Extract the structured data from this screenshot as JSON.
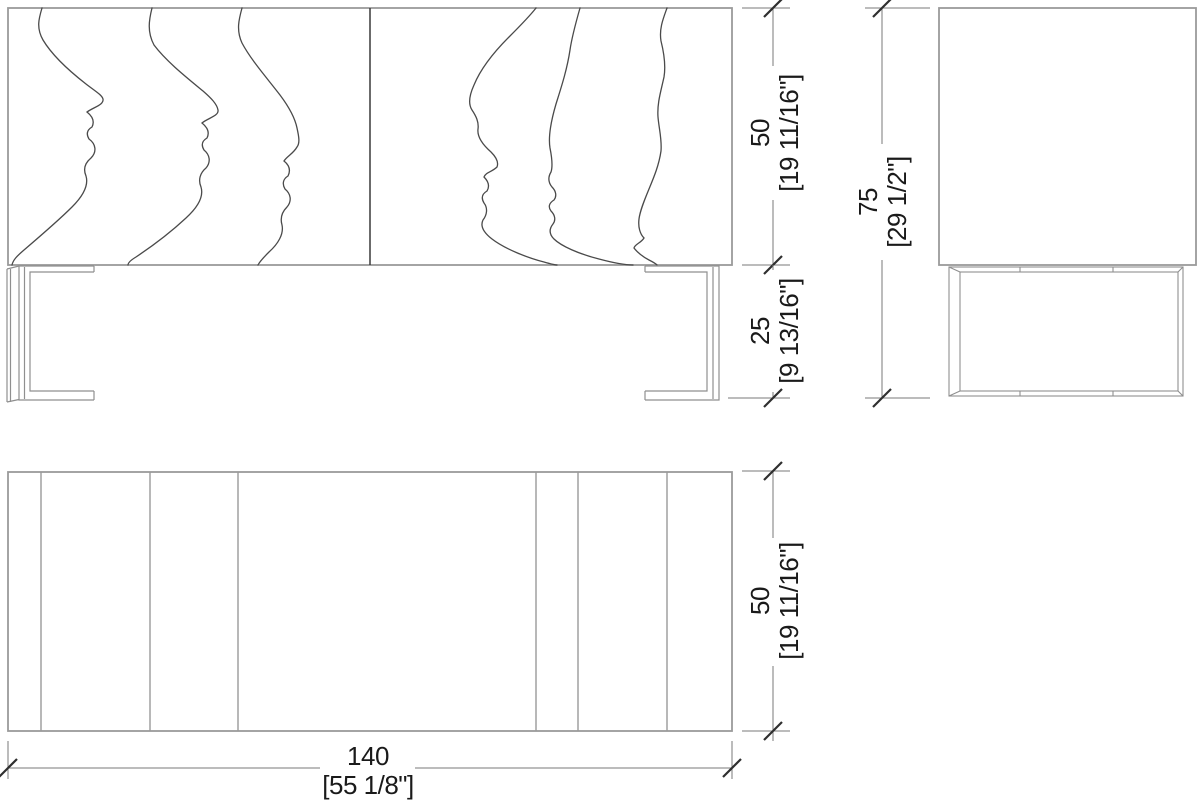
{
  "drawing_type": "furniture-dimension-drawing",
  "dimensions": {
    "cabinet_height": {
      "metric": "50",
      "imperial": "[19 11/16\"]"
    },
    "leg_height": {
      "metric": "25",
      "imperial": "[9 13/16\"]"
    },
    "total_height": {
      "metric": "75",
      "imperial": "[29 1/2\"]"
    },
    "depth": {
      "metric": "50",
      "imperial": "[19 11/16\"]"
    },
    "width": {
      "metric": "140",
      "imperial": "[55 1/8\"]"
    }
  },
  "colors": {
    "background": "#ffffff",
    "object_outline": "#9a9a9a",
    "carving_line": "#4a4a4a",
    "dimension_line": "#7a7a7a",
    "dimension_tick": "#2f2f2f",
    "dimension_text": "#1a1a1a"
  }
}
